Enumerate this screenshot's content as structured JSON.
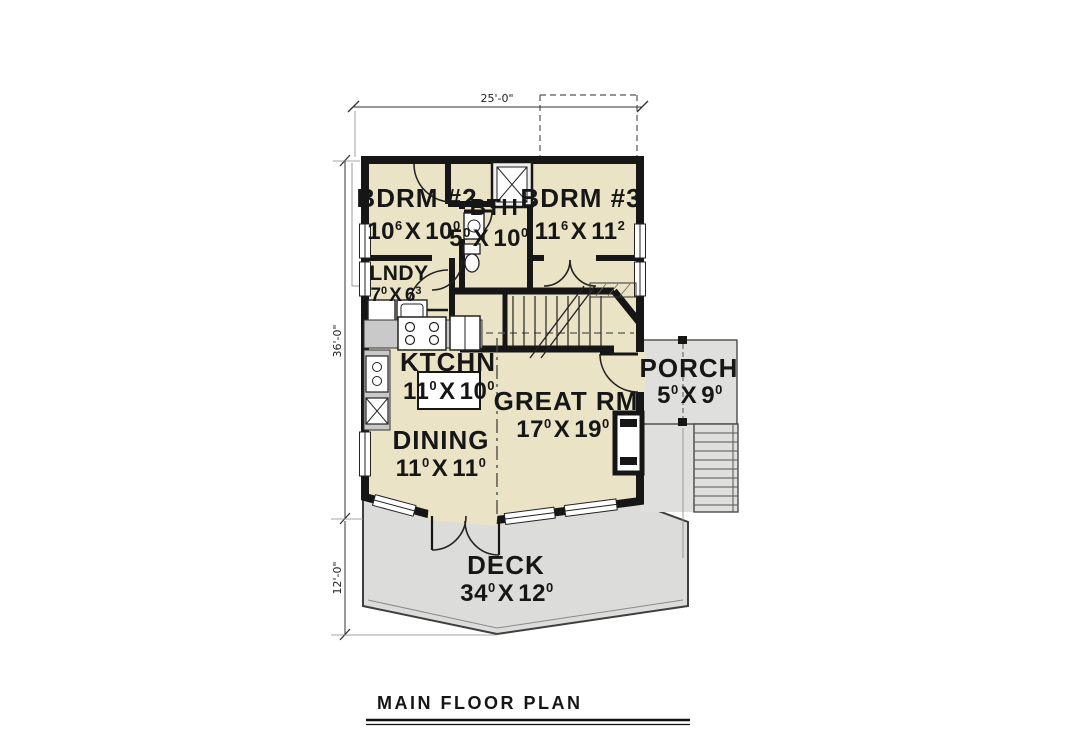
{
  "plan": {
    "title": "MAIN FLOOR PLAN",
    "dimensions": {
      "top": "25'-0\"",
      "left_upper": "36'-0\"",
      "left_lower": "12'-0\""
    }
  },
  "rooms": {
    "bdrm2": {
      "name": "BDRM #2",
      "dim": {
        "w": "10",
        "ws": "6",
        "sep": "X",
        "h": "10",
        "hs": "0"
      }
    },
    "bth": {
      "name": "BTH",
      "dim": {
        "w": "5",
        "ws": "0",
        "sep": "X",
        "h": "10",
        "hs": "0"
      }
    },
    "bdrm3": {
      "name": "BDRM #3",
      "dim": {
        "w": "11",
        "ws": "6",
        "sep": "X",
        "h": "11",
        "hs": "2"
      }
    },
    "lndy": {
      "name": "LNDY",
      "dim": {
        "w": "7",
        "ws": "0",
        "sep": "X",
        "h": "6",
        "hs": "3"
      }
    },
    "ktchn": {
      "name": "KTCHN",
      "dim": {
        "w": "11",
        "ws": "0",
        "sep": "X",
        "h": "10",
        "hs": "0"
      }
    },
    "great": {
      "name": "GREAT RM",
      "dim": {
        "w": "17",
        "ws": "0",
        "sep": "X",
        "h": "19",
        "hs": "0"
      }
    },
    "dining": {
      "name": "DINING",
      "dim": {
        "w": "11",
        "ws": "0",
        "sep": "X",
        "h": "11",
        "hs": "0"
      }
    },
    "porch": {
      "name": "PORCH",
      "dim": {
        "w": "5",
        "ws": "0",
        "sep": "X",
        "h": "9",
        "hs": "0"
      }
    },
    "deck": {
      "name": "DECK",
      "dim": {
        "w": "34",
        "ws": "0",
        "sep": "X",
        "h": "12",
        "hs": "0"
      }
    }
  },
  "colors": {
    "floor": "#ebe3c5",
    "deck_gray": "#dcdcdb",
    "wall": "#161616"
  }
}
